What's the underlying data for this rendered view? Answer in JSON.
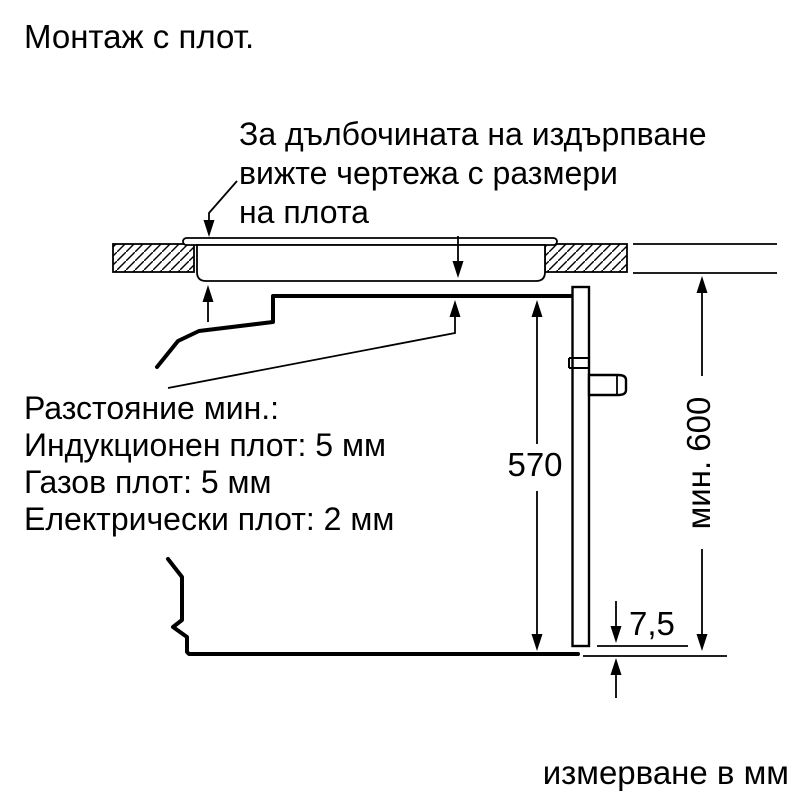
{
  "title": "Монтаж с плот.",
  "note": {
    "line1": "За дълбочината на издърпване",
    "line2": "вижте чертежа с размери",
    "line3": "на плота"
  },
  "clearances": {
    "heading": "Разстояние мин.:",
    "items": [
      "Индукционен плот: 5 мм",
      "Газов плот: 5 мм",
      "Електрически плот: 2 мм"
    ]
  },
  "dimensions": {
    "oven_height": "570",
    "niche_height": "мин. 600",
    "bottom_gap": "7,5"
  },
  "footer": "измерване в мм",
  "colors": {
    "line": "#000000",
    "background": "#ffffff"
  }
}
